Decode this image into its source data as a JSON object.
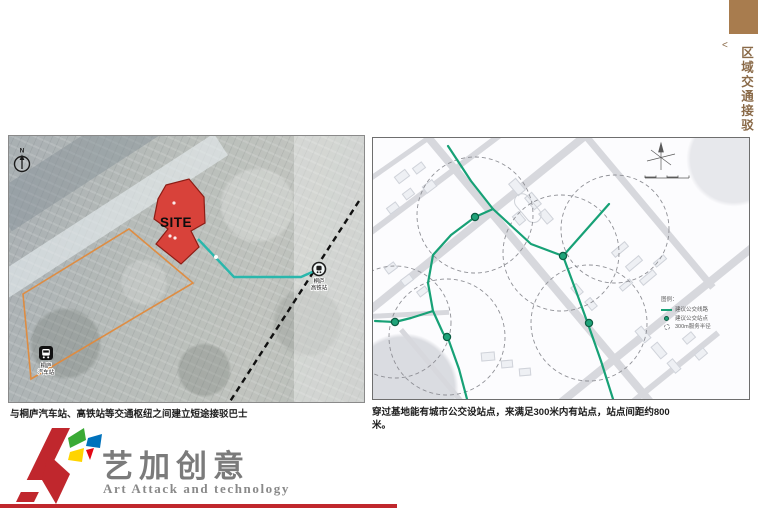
{
  "header": {
    "collapse": "<",
    "title": "区域交通接驳"
  },
  "left_map": {
    "north_label": "N",
    "site_label": "SITE",
    "hsr_station": {
      "line1": "桐庐",
      "line2": "高铁站"
    },
    "bus_station": {
      "line1": "桐庐",
      "line2": "汽车站"
    },
    "caption": "与桐庐汽车站、高铁站等交通枢纽之间建立短途接驳巴士"
  },
  "right_map": {
    "legend_title": "图例：",
    "legend": {
      "route": "建议公交线路",
      "stop": "建议公交站点",
      "radius": "300m服务半径"
    },
    "caption": "穿过基地能有城市公交设站点，来满足300米内有站点，站点间距约800米。"
  },
  "logo": {
    "cn": "艺加创意",
    "en": "Art Attack and technology"
  },
  "colors": {
    "tab_brown": "#a87c4e",
    "title_brown": "#8a6a48",
    "route_green": "#17a176",
    "site_red": "#d8423a",
    "boundary_orange": "#e08a3c",
    "logo_red": "#c0272d"
  }
}
